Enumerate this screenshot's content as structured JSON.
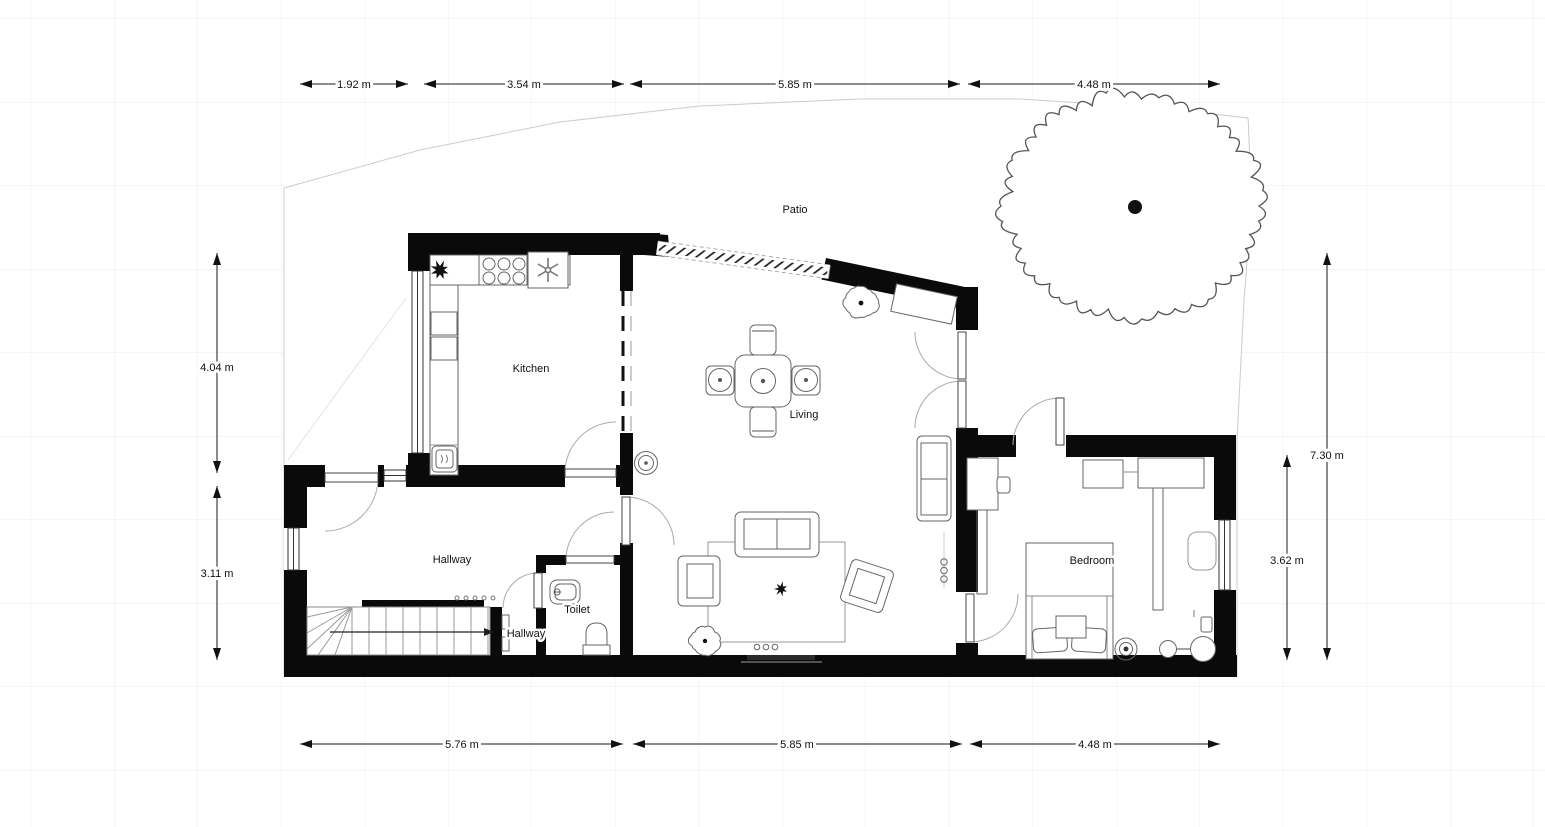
{
  "canvas": {
    "background": "#ffffff",
    "grid_color": "#ececec",
    "wall_color": "#0a0a0a"
  },
  "rooms": {
    "kitchen": "Kitchen",
    "living": "Living",
    "hallway": "Hallway",
    "hallway2": "Hallway",
    "toilet": "Toilet",
    "bedroom": "Bedroom",
    "patio": "Patio"
  },
  "dims": {
    "top": [
      "1.92 m",
      "3.54 m",
      "5.85 m",
      "4.48 m"
    ],
    "left": [
      "4.04 m",
      "3.11 m"
    ],
    "right": [
      "7.30 m",
      "3.62 m"
    ],
    "bottom": [
      "5.76 m",
      "5.85 m",
      "4.48 m"
    ]
  }
}
